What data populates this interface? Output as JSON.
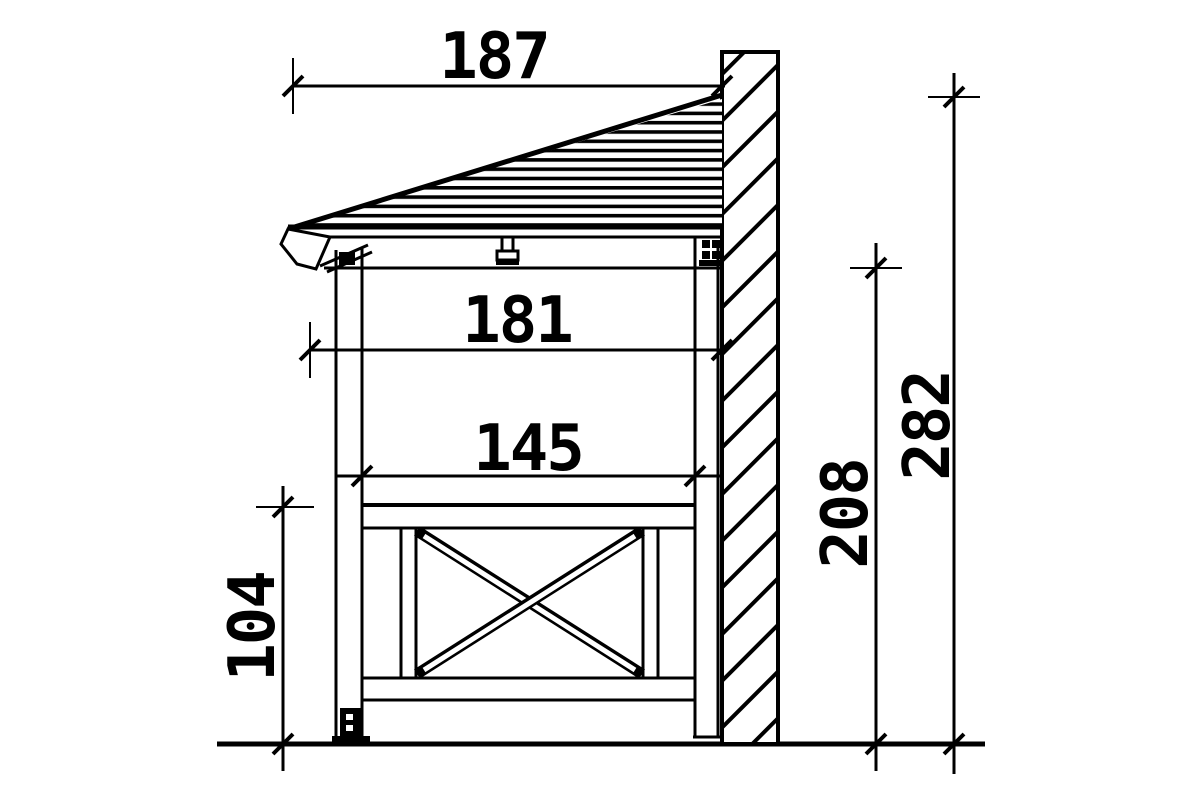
{
  "drawing": {
    "background": "#ffffff",
    "line_color": "#000000",
    "dimensions": {
      "top_width": "187",
      "middle_width": "181",
      "inner_width": "145",
      "left_height": "104",
      "inner_height": "208",
      "outer_height": "282"
    }
  }
}
